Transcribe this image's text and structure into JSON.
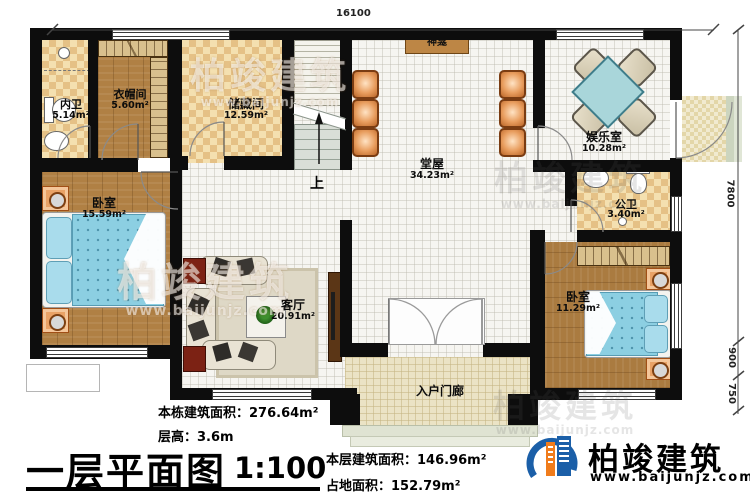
{
  "plan": {
    "title": "一层平面图",
    "scale": "1:100",
    "stats": {
      "building_area": "本栋建筑面积：276.64m²",
      "floor_height": "层高：3.6m",
      "floor_area": "本层建筑面积：146.96m²",
      "land_area": "占地面积：152.79m²"
    }
  },
  "rooms": {
    "inner_bath": {
      "name": "内卫",
      "area": "5.14m²"
    },
    "cloakroom": {
      "name": "衣帽间",
      "area": "5.60m²"
    },
    "storage": {
      "name": "储藏间",
      "area": "12.59m²"
    },
    "hall": {
      "name": "堂屋",
      "area": "34.23m²"
    },
    "entertainment": {
      "name": "娱乐室",
      "area": "10.28m²"
    },
    "public_bath": {
      "name": "公卫",
      "area": "3.40m²"
    },
    "bedroom_left": {
      "name": "卧室",
      "area": "15.59m²"
    },
    "living": {
      "name": "客厅",
      "area": "20.91m²"
    },
    "bedroom_right": {
      "name": "卧室",
      "area": "11.29m²"
    },
    "entry_porch": {
      "name": "入户门廊"
    }
  },
  "annotations": {
    "shrine": "神龛",
    "stairs_up": "上"
  },
  "dimensions": {
    "top": "16100",
    "right_upper": "7800",
    "right_mid": "900",
    "right_lower": "750"
  },
  "brand": {
    "name": "柏竣建筑",
    "url": "www.baijunjz.com"
  },
  "watermark": {
    "name": "柏竣建筑",
    "url": "www.baijunjz.com"
  },
  "colors": {
    "wall": "#0d0d0d",
    "brand_blue": "#1b5fa8",
    "brand_orange": "#f07c1c"
  }
}
